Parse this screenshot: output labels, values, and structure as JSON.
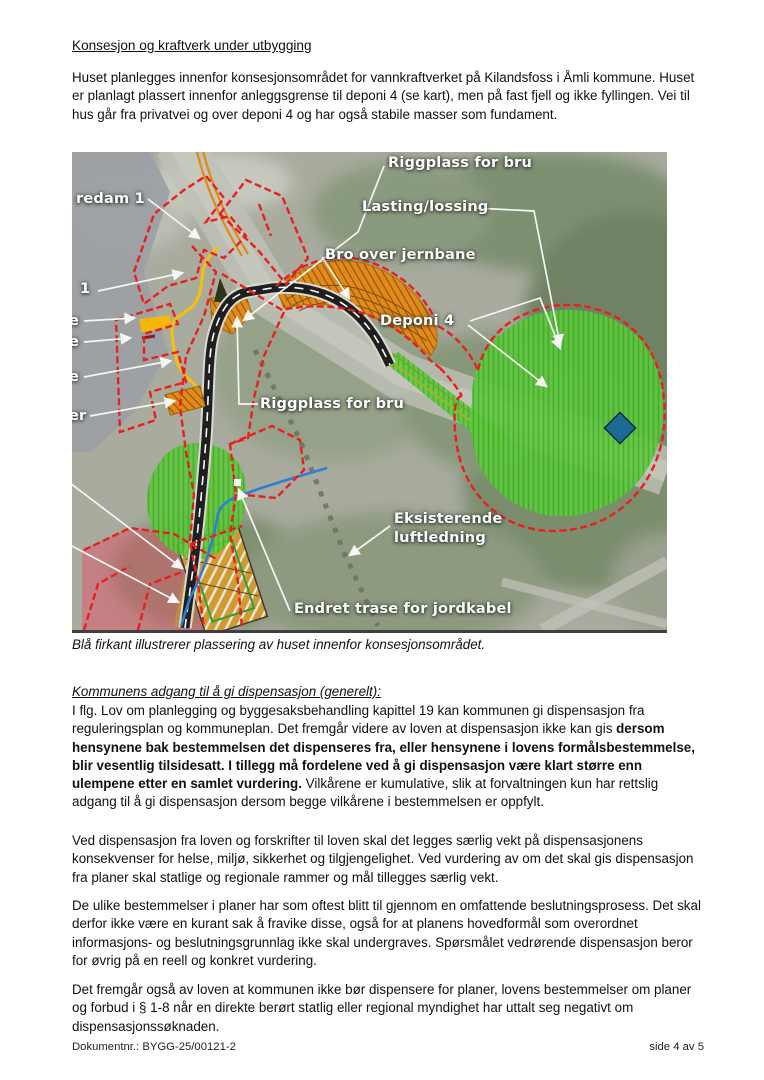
{
  "page": {
    "heading1": "Konsesjon og kraftverk under utbygging",
    "intro": "Huset planlegges innenfor konsesjonsområdet for vannkraftverket på Kilandsfoss i Åmli kommune. Huset er planlagt plassert innenfor anleggsgrense til deponi 4 (se kart), men på fast fjell og ikke fyllingen. Vei til hus går fra privatvei og over deponi 4 og har også stabile masser som fundament.",
    "caption": "Blå firkant illustrerer plassering av huset innenfor konsesjonsområdet.",
    "heading2": "Kommunens adgang til å gi dispensasjon (generelt):",
    "para2": {
      "runs": [
        {
          "text": "I flg. Lov om planlegging og byggesaksbehandling kapittel 19 kan kommunen gi dispensasjon fra reguleringsplan og kommuneplan. Det fremgår videre av loven at dispensasjon ikke kan gis ",
          "bold": false
        },
        {
          "text": "dersom hensynene bak bestemmelsen det dispenseres fra, eller hensynene i lovens formålsbestemmelse, blir vesentlig tilsidesatt. I tillegg må fordelene ved å gi dispensasjon være klart større enn ulempene etter en samlet vurdering.",
          "bold": true
        },
        {
          "text": " Vilkårene er kumulative, slik at forvaltningen kun har rettslig adgang til å gi dispensasjon dersom begge vilkårene i bestemmelsen er oppfylt.",
          "bold": false
        }
      ]
    },
    "para3": "Ved dispensasjon fra loven og forskrifter til loven skal det legges særlig vekt på dispensasjonens konsekvenser for helse, miljø, sikkerhet og tilgjengelighet. Ved vurdering av om det skal gis dispensasjon fra planer skal statlige og regionale rammer og mål tillegges særlig vekt.",
    "para4": "De ulike bestemmelser i planer har som oftest blitt til gjennom en omfattende beslutningsprosess. Det skal derfor ikke være en kurant sak å fravike disse, også for at planens hovedformål som overordnet informasjons- og beslutningsgrunnlag ikke skal undergraves. Spørsmålet vedrørende dispensasjon beror for øvrig på en reell og konkret vurdering.",
    "para5": "Det fremgår også av loven at kommunen ikke bør dispensere for planer, lovens bestemmelser om planer og forbud i § 1-8 når en direkte berørt statlig eller regional myndighet har uttalt seg negativt om dispensasjonssøknaden.",
    "footer": {
      "left": "Dokumentnr.: BYGG-25/00121-2",
      "right": "side 4 av 5"
    }
  },
  "map": {
    "labels": [
      {
        "id": "label-riggplass-for-bru-top",
        "text": "Riggplass for bru",
        "x": 316,
        "y": 2
      },
      {
        "id": "label-lasting-lossing",
        "text": "Lasting/lossing",
        "x": 290,
        "y": 46
      },
      {
        "id": "label-bro-over-jernbane",
        "text": "Bro over jernbane",
        "x": 253,
        "y": 94
      },
      {
        "id": "label-fangedam-1-cut",
        "text": "redam 1",
        "x": 4,
        "y": 38
      },
      {
        "id": "label-1-cut",
        "text": "1",
        "x": 8,
        "y": 128
      },
      {
        "id": "label-e-cut-1",
        "text": "e",
        "x": -3,
        "y": 160
      },
      {
        "id": "label-e-cut-2",
        "text": "e",
        "x": -3,
        "y": 181
      },
      {
        "id": "label-e-cut-3",
        "text": "e",
        "x": -3,
        "y": 216
      },
      {
        "id": "label-er-cut",
        "text": "er",
        "x": -3,
        "y": 255
      },
      {
        "id": "label-deponi-4",
        "text": "Deponi 4",
        "x": 308,
        "y": 160
      },
      {
        "id": "label-riggplass-for-bru-mid",
        "text": "Riggplass for bru",
        "x": 188,
        "y": 243
      },
      {
        "id": "label-eksisterende-luftledning",
        "text": "Eksisterende\nluftledning",
        "x": 322,
        "y": 358
      },
      {
        "id": "label-endret-trase-jordkabel",
        "text": "Endret trase for jordkabel",
        "x": 222,
        "y": 448
      }
    ],
    "colors": {
      "boundary_red": "#e8201d",
      "construction_orange": "#e2891b",
      "deposit_green": "#57c437",
      "house_square_blue": "#1c6a92",
      "cable_blue": "#2f7fd0",
      "path_yellow": "#f2c012"
    }
  }
}
